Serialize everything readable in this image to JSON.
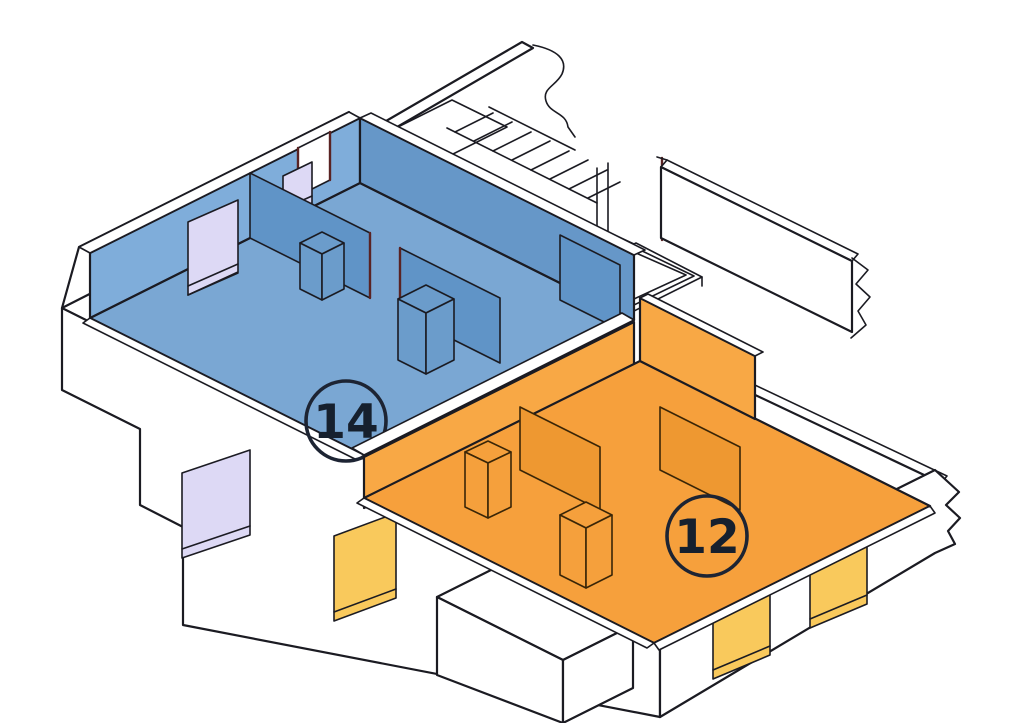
{
  "diagram": {
    "title": "isometric-floorplan-cutaway",
    "units": [
      {
        "id": "unit-14",
        "label": "14",
        "role": "apartment",
        "wall_color": "#7fadda",
        "floor_color": "#7aa7d3",
        "window_color": "#ddd9f5"
      },
      {
        "id": "unit-12",
        "label": "12",
        "role": "apartment",
        "wall_color": "#f8a845",
        "floor_color": "#f6a03c",
        "window_color": "#f9c95c"
      }
    ],
    "colors": {
      "background": "#ffffff",
      "outline": "#1b1b22",
      "structure_fill": "#ffffff",
      "door_frame_accent": "#5a2323"
    },
    "features": [
      "staircase",
      "stair-landing",
      "shaft-opening",
      "break-lines-right",
      "white-base-walls",
      "window-openings",
      "party-wall"
    ]
  }
}
